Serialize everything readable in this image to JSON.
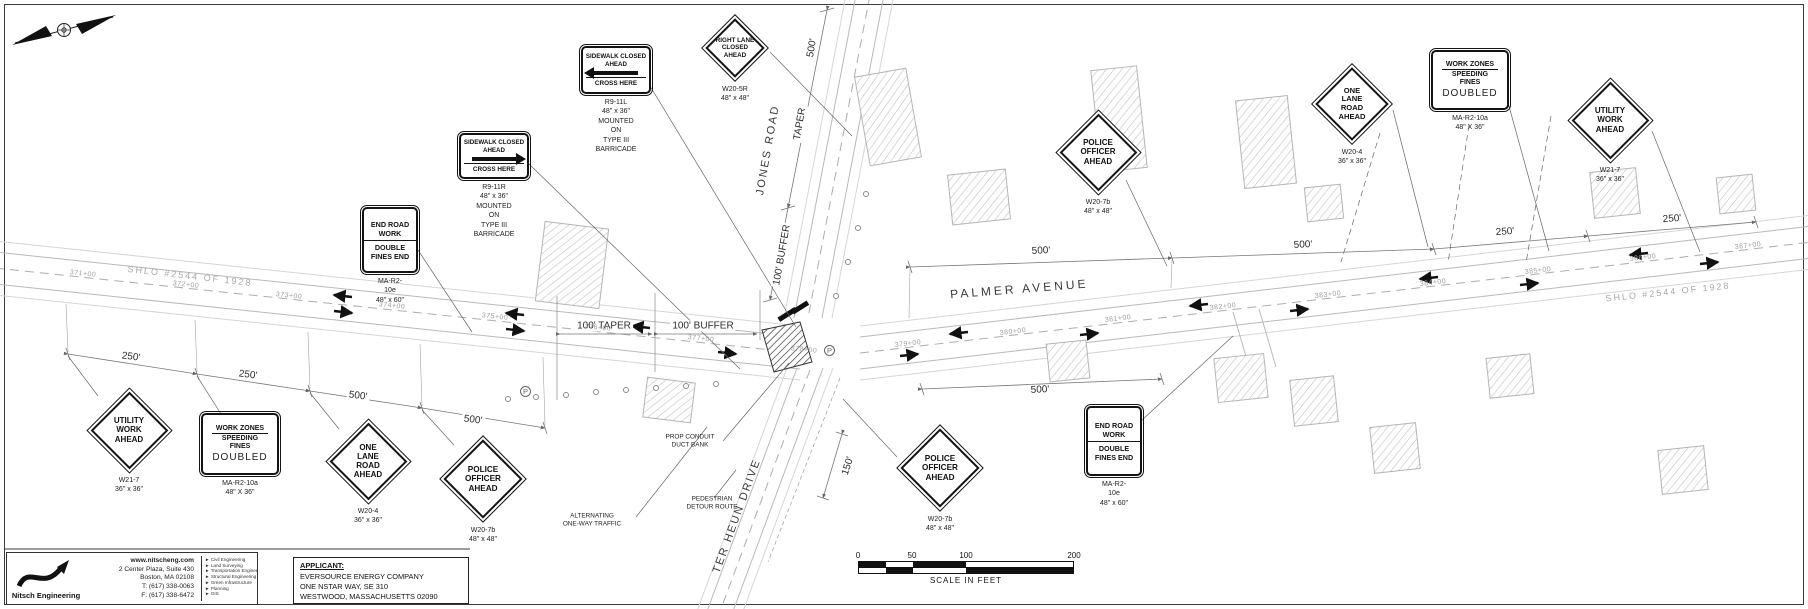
{
  "colors": {
    "paper": "#ffffff",
    "ink": "#141414",
    "linework": "#b5b5b5",
    "muted": "#9f9f9f"
  },
  "roads": {
    "palmer_avenue": "PALMER AVENUE",
    "jones_road": "JONES ROAD",
    "ter_heun_drive": "TER HEUN DRIVE",
    "shlo_west": "SHLO #2544 OF 1928",
    "shlo_east": "SHLO #2544 OF 1928"
  },
  "stations_west": [
    "371+00",
    "372+00",
    "373+00",
    "374+00",
    "375+00",
    "376+00",
    "377+00",
    "378+00"
  ],
  "stations_east": [
    "379+00",
    "380+00",
    "381+00",
    "382+00",
    "383+00",
    "384+00",
    "385+00",
    "386+00",
    "387+00"
  ],
  "signs": [
    {
      "id": "utility-work-west",
      "type": "diamond",
      "lines": [
        "UTILITY",
        "WORK",
        "AHEAD"
      ],
      "code": [
        "W21-7",
        "36\" x 36\""
      ]
    },
    {
      "id": "work-zones-west",
      "type": "fines",
      "head": "WORK ZONES",
      "mid": [
        "SPEEDING",
        "FINES"
      ],
      "big": "DOUBLED",
      "code": [
        "MA-R2-10a",
        "48\" X 36\""
      ]
    },
    {
      "id": "one-lane-road-west",
      "type": "diamond",
      "lines": [
        "ONE",
        "LANE",
        "ROAD",
        "AHEAD"
      ],
      "code": [
        "W20-4",
        "36\" x 36\""
      ]
    },
    {
      "id": "police-officer-west",
      "type": "diamond",
      "lines": [
        "POLICE",
        "OFFICER",
        "AHEAD"
      ],
      "code": [
        "W20-7b",
        "48\" x 48\""
      ]
    },
    {
      "id": "end-road-work-west",
      "type": "double",
      "top": [
        "END ROAD",
        "WORK"
      ],
      "bottom": [
        "DOUBLE",
        "FINES END"
      ],
      "code": [
        "MA-R2-10e",
        "48\" x 60\""
      ]
    },
    {
      "id": "sidewalk-closed-right",
      "type": "sidewalk",
      "arrow": "right",
      "top": [
        "SIDEWALK CLOSED",
        "AHEAD"
      ],
      "bottom": "CROSS HERE",
      "code": [
        "R9-11R",
        "48\" x 36\"",
        "MOUNTED ON",
        "TYPE III BARRICADE"
      ]
    },
    {
      "id": "sidewalk-closed-left",
      "type": "sidewalk",
      "arrow": "left",
      "top": [
        "SIDEWALK CLOSED",
        "AHEAD"
      ],
      "bottom": "CROSS HERE",
      "code": [
        "R9-11L",
        "48\" x 36\"",
        "MOUNTED ON",
        "TYPE III BARRICADE"
      ]
    },
    {
      "id": "right-lane-closed-ahead",
      "type": "diamond",
      "lines": [
        "RIGHT LANE",
        "CLOSED",
        "AHEAD"
      ],
      "code": [
        "W20-5R",
        "48\" x 48\""
      ]
    },
    {
      "id": "police-officer-northeast",
      "type": "diamond",
      "lines": [
        "POLICE",
        "OFFICER",
        "AHEAD"
      ],
      "code": [
        "W20-7b",
        "48\" x 48\""
      ]
    },
    {
      "id": "one-lane-road-east",
      "type": "diamond",
      "lines": [
        "ONE",
        "LANE",
        "ROAD",
        "AHEAD"
      ],
      "code": [
        "W20-4",
        "36\" x 36\""
      ]
    },
    {
      "id": "work-zones-east",
      "type": "fines",
      "head": "WORK ZONES",
      "mid": [
        "SPEEDING",
        "FINES"
      ],
      "big": "DOUBLED",
      "code": [
        "MA-R2-10a",
        "48\" X 36\""
      ]
    },
    {
      "id": "utility-work-east",
      "type": "diamond",
      "lines": [
        "UTILITY",
        "WORK",
        "AHEAD"
      ],
      "code": [
        "W21-7",
        "36\" x 36\""
      ]
    },
    {
      "id": "end-road-work-east",
      "type": "double",
      "top": [
        "END ROAD",
        "WORK"
      ],
      "bottom": [
        "DOUBLE",
        "FINES END"
      ],
      "code": [
        "MA-R2-10e",
        "48\" x 60\""
      ]
    },
    {
      "id": "police-officer-south",
      "type": "diamond",
      "lines": [
        "POLICE",
        "OFFICER",
        "AHEAD"
      ],
      "code": [
        "W20-7b",
        "48\" x 48\""
      ]
    }
  ],
  "dimensions": [
    "250'",
    "250'",
    "500'",
    "500'",
    "100' TAPER",
    "100' BUFFER",
    "500'",
    "500'",
    "250'",
    "250'",
    "500'",
    "500'",
    "TAPER",
    "100' BUFFER",
    "150'"
  ],
  "notes": {
    "prop_conduit": [
      "PROP CONDUIT",
      "DUCT BANK"
    ],
    "alternating": [
      "ALTERNATING",
      "ONE-WAY TRAFFIC"
    ],
    "pedestrian": [
      "PEDESTRIAN",
      "DETOUR ROUTE"
    ]
  },
  "parking_symbol": "P",
  "scale_bar": {
    "ticks": [
      "0",
      "50",
      "100",
      "200"
    ],
    "label": "SCALE IN FEET"
  },
  "applicant": {
    "heading": "APPLICANT:",
    "lines": [
      "EVERSOURCE ENERGY COMPANY",
      "ONE NSTAR WAY, SE 310",
      "WESTWOOD, MASSACHUSETTS 02090"
    ]
  },
  "engineer": {
    "firm": "Nitsch Engineering",
    "website": "www.nitscheng.com",
    "address": [
      "2 Center Plaza, Suite 430",
      "Boston, MA 02108"
    ],
    "phone": "T: (617) 338-0063",
    "fax": "F: (617) 338-6472",
    "services": [
      "Civil Engineering",
      "Land Surveying",
      "Transportation Engineering",
      "Structural Engineering",
      "Green Infrastructure",
      "Planning",
      "GIS"
    ]
  }
}
